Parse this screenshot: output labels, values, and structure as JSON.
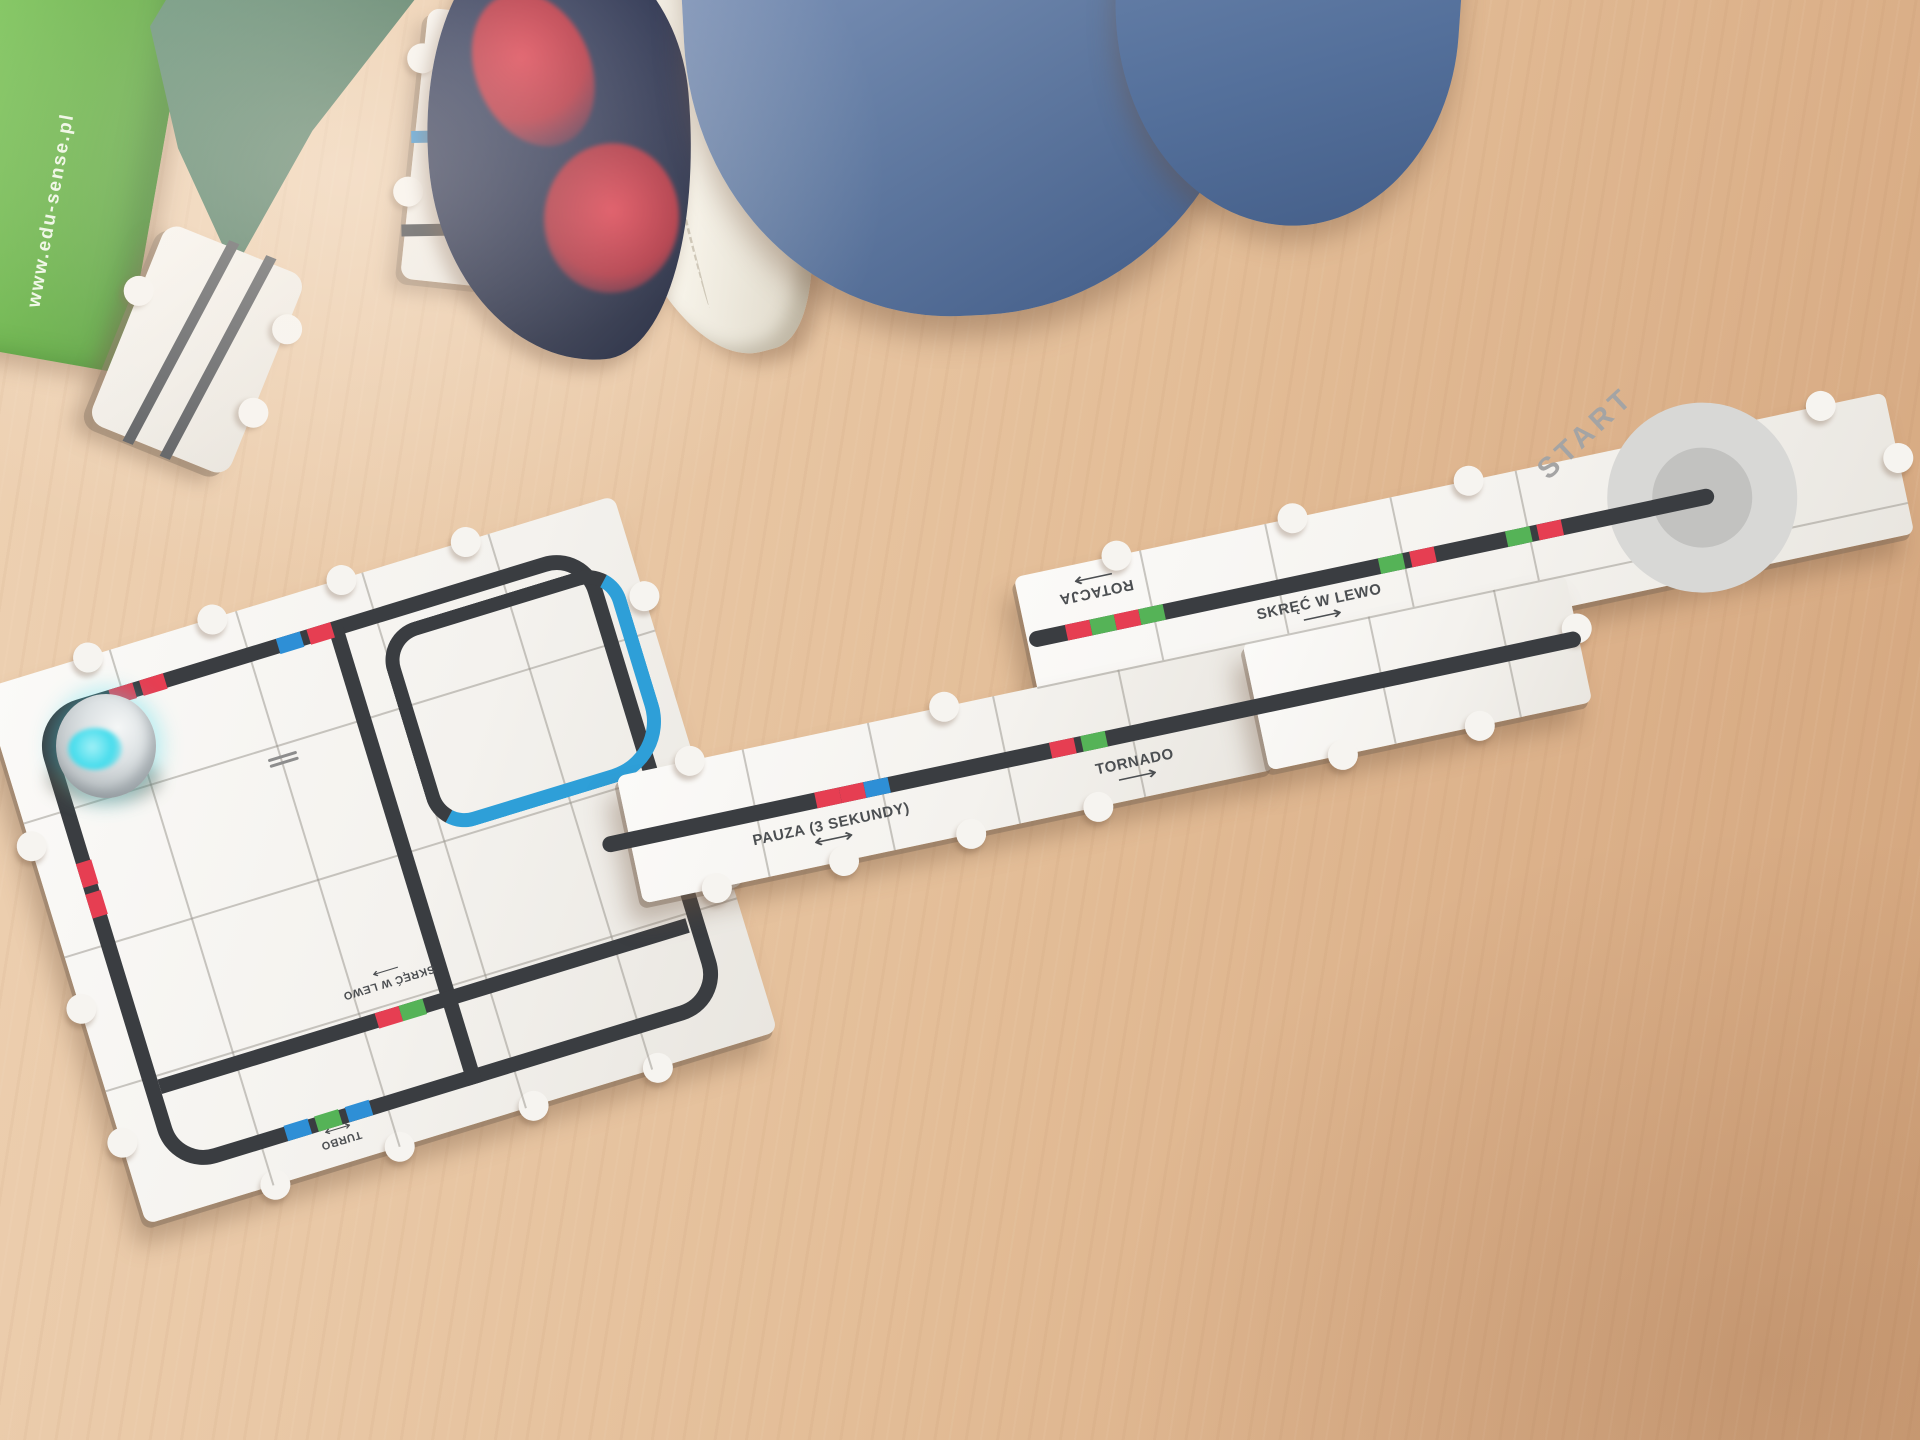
{
  "edu_box": {
    "url": "www.edu-sense.pl",
    "green": "#5fae3f"
  },
  "labels": {
    "start": "START",
    "pause": "PAUZA (3 SEKUNDY)",
    "tornado": "TORNADO",
    "rotation": "ROTACJA",
    "turn_left": "SKRĘĆ W LEWO",
    "board_turn_left": "SKRĘĆ W LEWO",
    "board_turbo": "TURBO"
  },
  "arrows": {
    "right": "⟶",
    "left": "⟵",
    "both": "⟷"
  },
  "code_colors": {
    "red": "#e63e52",
    "green": "#55b357",
    "blue": "#2e8fd6"
  },
  "codes": {
    "pause": [
      "red",
      "red",
      "blue"
    ],
    "tornado": [
      "red",
      "green"
    ],
    "rotation": [
      "red",
      "green",
      "red",
      "green"
    ],
    "turn_left": [
      "green",
      "red"
    ],
    "start_approach": [
      "green",
      "red"
    ],
    "board_top_left": [
      "red",
      "red"
    ],
    "board_top_right": [
      "blue",
      "red"
    ],
    "board_inner": [
      "red",
      "green"
    ],
    "board_bottom": [
      "blue",
      "green",
      "blue"
    ],
    "board_left": [
      "red",
      "red"
    ]
  },
  "path": {
    "line_color": "#3a3d41",
    "blue_line_color": "#2e9fd8"
  },
  "robot": {
    "type": "ozobot",
    "light_color": "#46dcec"
  }
}
